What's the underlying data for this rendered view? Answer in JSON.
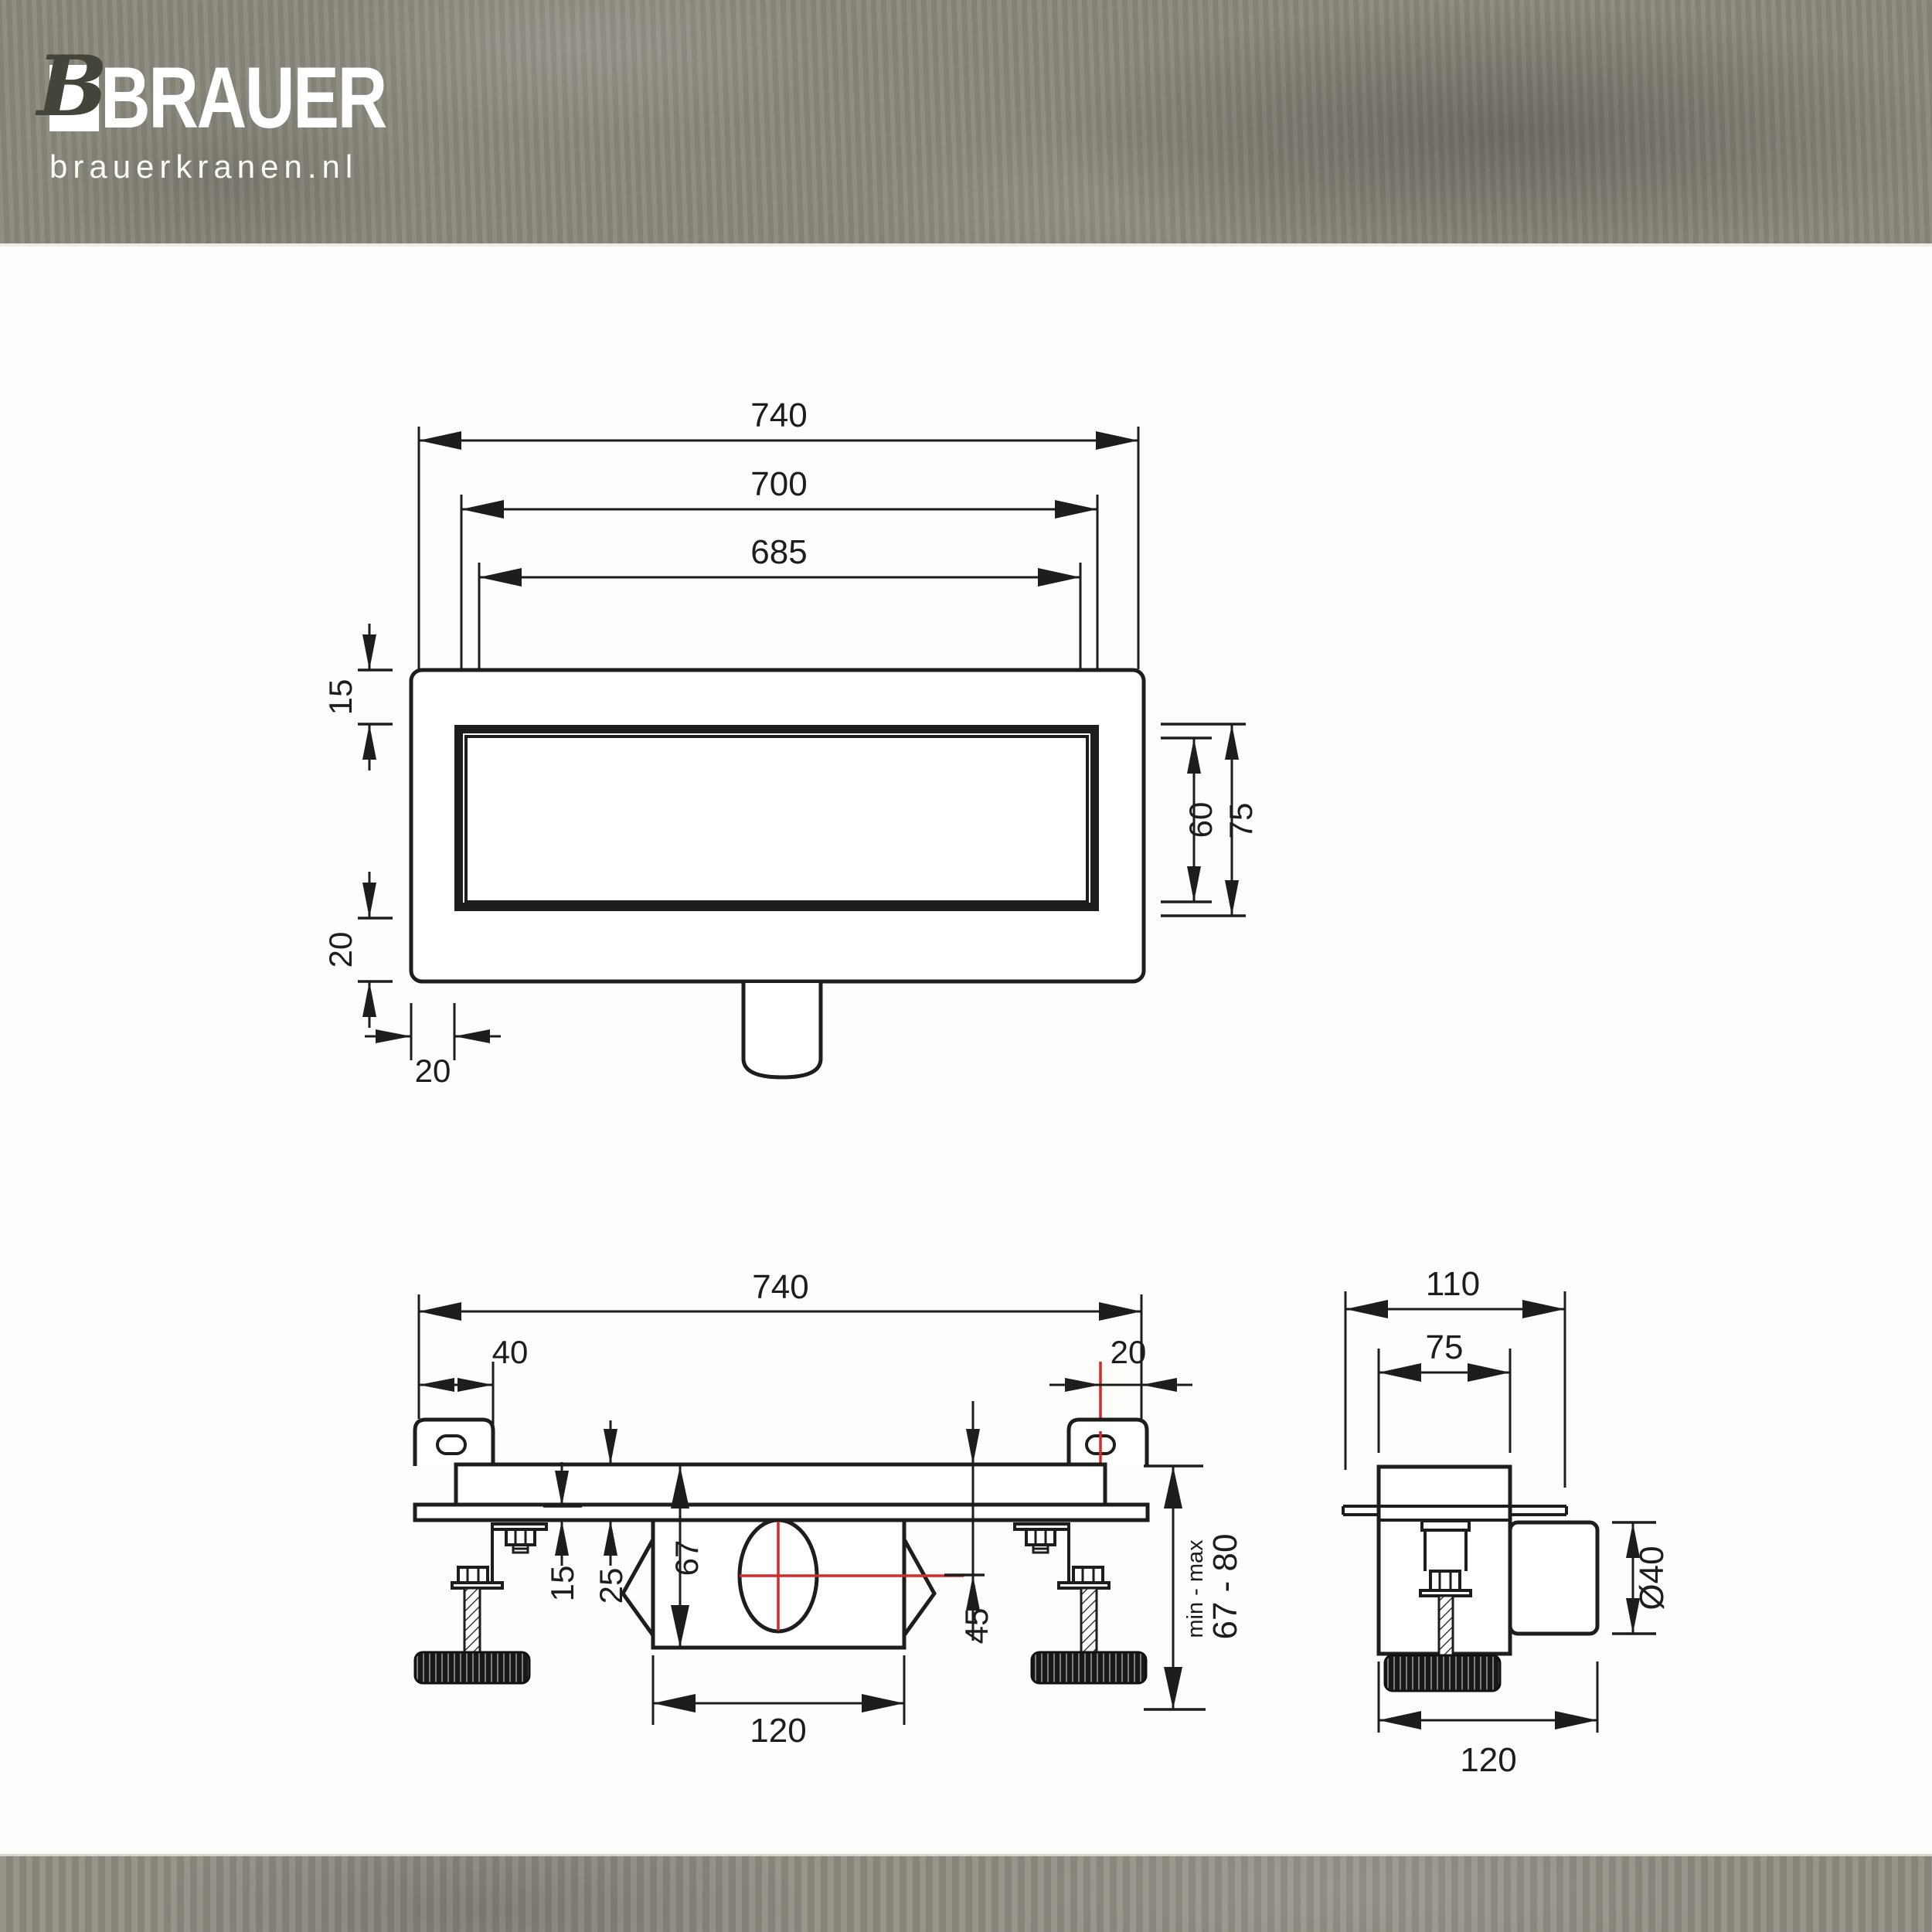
{
  "brand": {
    "mark_letter": "B",
    "name": "BRAUER",
    "site": "brauerkranen.nl"
  },
  "colors": {
    "accent_red": "#d42a2e",
    "line_black": "#1d1d1b",
    "band_top_gray": "#8a877c",
    "band_bottom_gray": "#8f8c82"
  },
  "plan_view": {
    "dims": {
      "overall_width": "740",
      "cutout_width": "700",
      "grate_width": "685",
      "top_edge": "15",
      "bottom_edge": "20",
      "left_edge": "20",
      "grate_height": "60",
      "frame_height": "75"
    }
  },
  "front_view": {
    "dims": {
      "overall_width": "740",
      "bracket_offset": "40",
      "bracket_edge": "20",
      "rim_height": "15",
      "body_depth": "25",
      "trap_depth": "67",
      "outlet_center_height": "45",
      "trap_width": "120",
      "adjust_label": "min - max",
      "adjust_range": "67 - 80"
    }
  },
  "side_view": {
    "dims": {
      "overall_depth": "110",
      "channel_width": "75",
      "outlet_diameter": "Ø40",
      "base_depth": "120"
    }
  }
}
